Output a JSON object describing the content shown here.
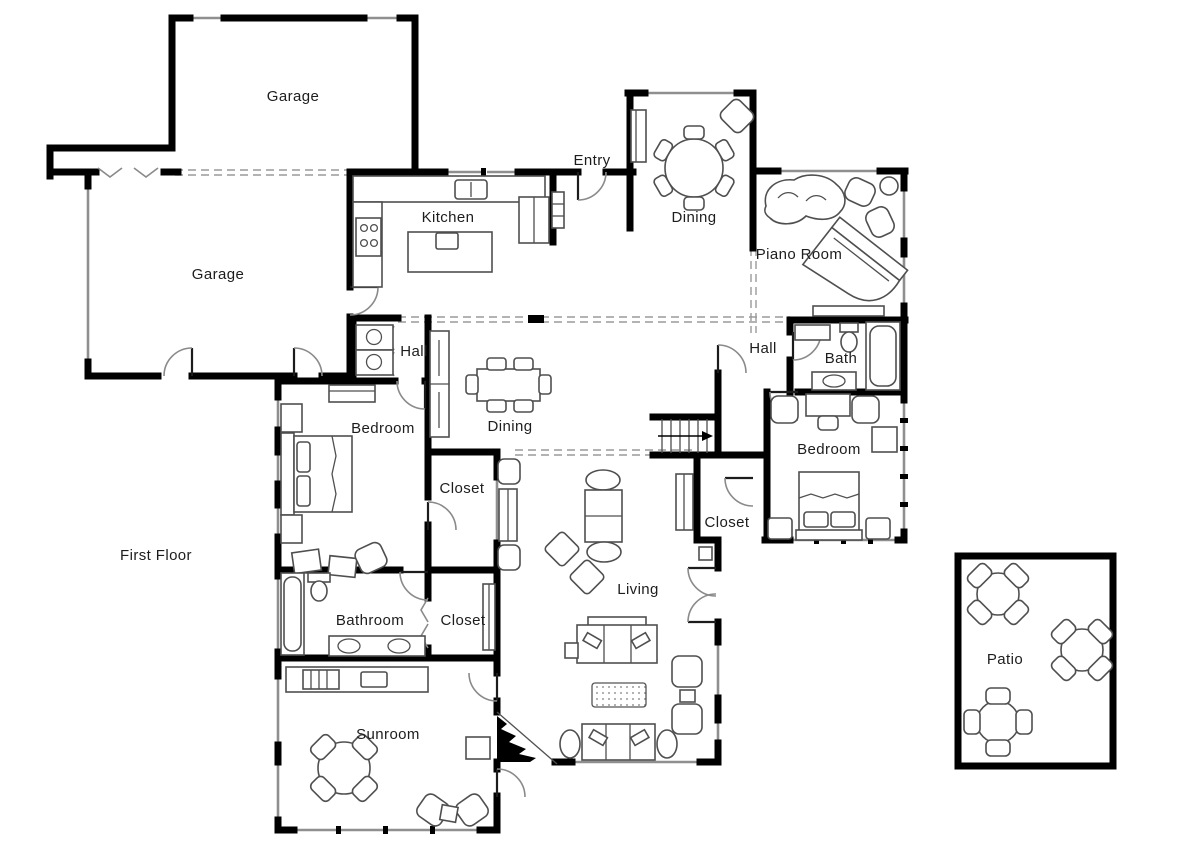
{
  "plan": {
    "floor_label": "First Floor",
    "rooms": {
      "garage_upper": "Garage",
      "garage_lower": "Garage",
      "kitchen": "Kitchen",
      "entry": "Entry",
      "dining_breakfast": "Dining",
      "piano_room": "Piano Room",
      "hall_left": "Hall",
      "hall_right": "Hall",
      "bath": "Bath",
      "bedroom_left": "Bedroom",
      "dining_formal": "Dining",
      "closet_middle": "Closet",
      "closet_right": "Closet",
      "bedroom_right": "Bedroom",
      "living": "Living",
      "bathroom": "Bathroom",
      "closet_bottom": "Closet",
      "sunroom": "Sunroom",
      "patio": "Patio"
    },
    "colors": {
      "wall": "#000000",
      "window": "#8f8f8f",
      "furniture": "#4f4f4f",
      "dashed_line": "#9a9a9a",
      "text": "#1d1d1d",
      "background": "#ffffff"
    }
  }
}
